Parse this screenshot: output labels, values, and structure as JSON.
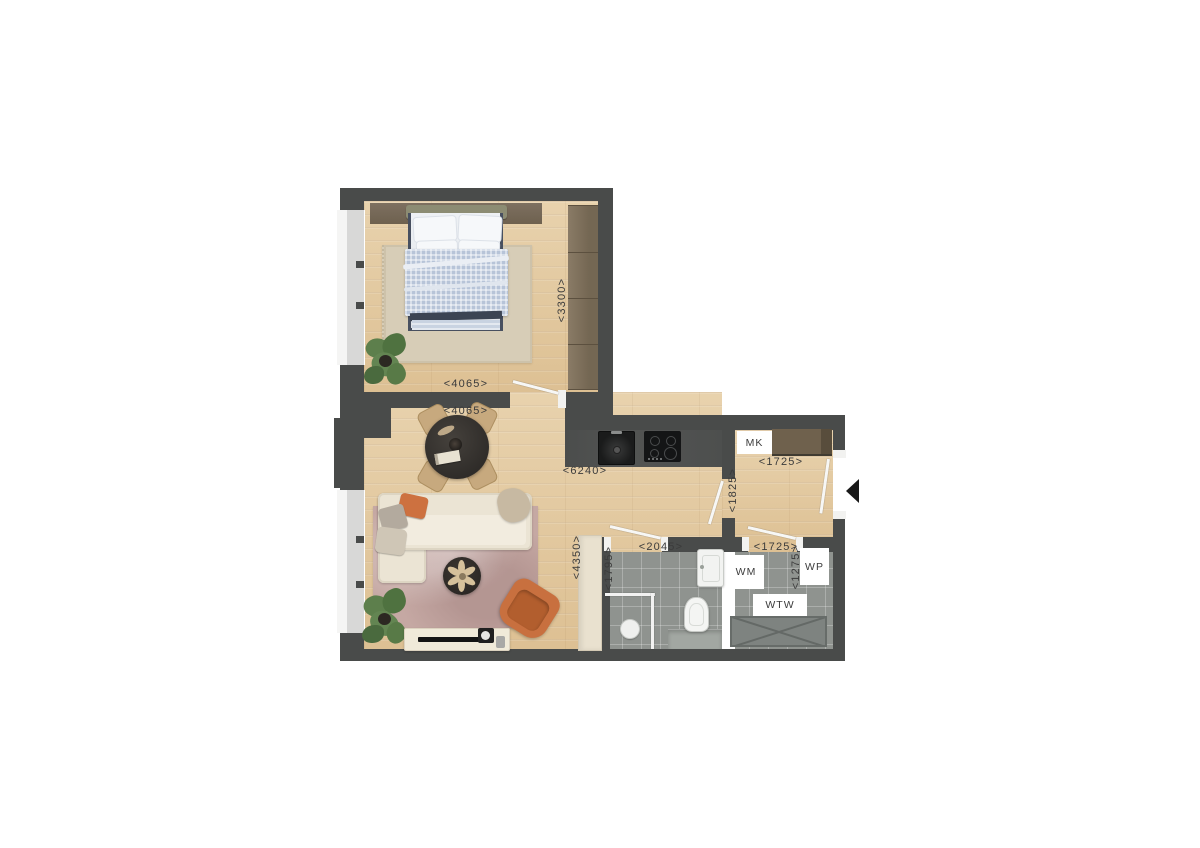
{
  "colors": {
    "wall": "#494b4a",
    "wood_floor": "#e4cba2",
    "tile_floor": "#8f938f",
    "wardrobe_brown": "#7b6d5a",
    "meter_cupboard_brown": "#6f614d",
    "entrance_marker": "#191919",
    "sofa_cream": "#ebe4d4",
    "rug_rose": "#c5a8a3",
    "accent_orange": "#c8703f",
    "duvet_blue": "#b7c4d8"
  },
  "dimension_labels": {
    "bedroom_width": "<4065>",
    "living_width": "<4065>",
    "bedroom_depth": "<3300>",
    "living_kitchen_length": "<6240>",
    "hall_depth": "<1825>",
    "hall_width": "<1725>",
    "bathroom_width": "<2045>",
    "bathroom_depth": "<1795>",
    "living_depth": "<4350>",
    "utility_width": "<1725>",
    "utility_depth": "<1275>"
  },
  "fixture_labels": {
    "meter_cupboard": "MK",
    "washing_machine": "WM",
    "heat_recovery": "WTW",
    "heat_pump": "WP"
  }
}
